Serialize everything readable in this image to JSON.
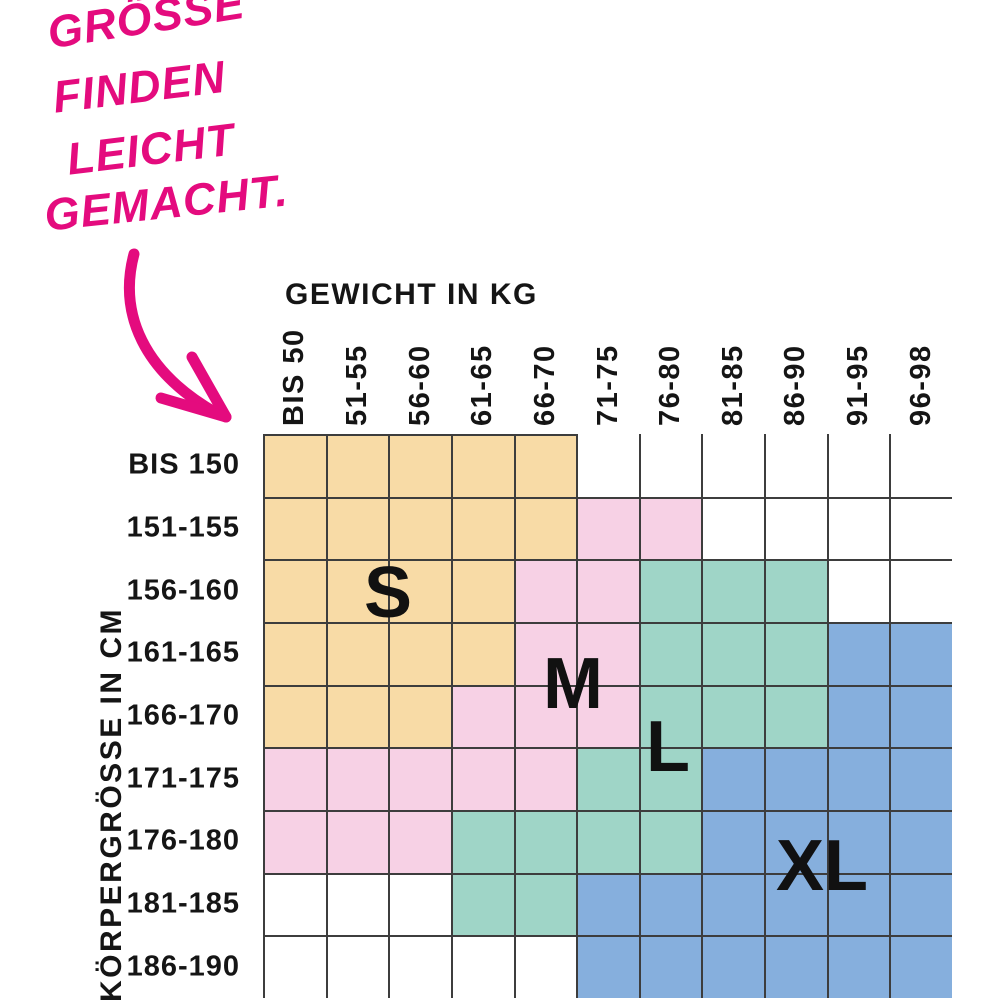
{
  "annotation": {
    "color": "#E40B7E",
    "lines": [
      {
        "text": "GRÖSSE",
        "x": 44,
        "y": 8,
        "rotate": -9
      },
      {
        "text": "FINDEN",
        "x": 50,
        "y": 72,
        "rotate": -7
      },
      {
        "text": "LEICHT",
        "x": 64,
        "y": 134,
        "rotate": -7
      },
      {
        "text": "GEMACHT.",
        "x": 42,
        "y": 190,
        "rotate": -6
      }
    ]
  },
  "chart_data": {
    "type": "heatmap",
    "title_columns": "GEWICHT IN KG",
    "title_rows": "KÖRPERGRÖSSE IN CM",
    "columns": [
      "BIS 50",
      "51-55",
      "56-60",
      "61-65",
      "66-70",
      "71-75",
      "76-80",
      "81-85",
      "86-90",
      "91-95",
      "96-98"
    ],
    "rows": [
      "BIS 150",
      "151-155",
      "156-160",
      "161-165",
      "166-170",
      "171-175",
      "176-180",
      "181-185",
      "186-190"
    ],
    "legend": [
      {
        "size": "S",
        "color": "#F8DBA6"
      },
      {
        "size": "M",
        "color": "#F7D1E5"
      },
      {
        "size": "L",
        "color": "#9FD5C7"
      },
      {
        "size": "XL",
        "color": "#86AFDD"
      }
    ],
    "matrix": [
      [
        "S",
        "S",
        "S",
        "S",
        "S",
        "",
        "",
        "",
        "",
        "",
        ""
      ],
      [
        "S",
        "S",
        "S",
        "S",
        "S",
        "M",
        "M",
        "",
        "",
        "",
        ""
      ],
      [
        "S",
        "S",
        "S",
        "S",
        "M",
        "M",
        "L",
        "L",
        "L",
        "",
        ""
      ],
      [
        "S",
        "S",
        "S",
        "S",
        "M",
        "M",
        "L",
        "L",
        "L",
        "XL",
        "XL"
      ],
      [
        "S",
        "S",
        "S",
        "M",
        "M",
        "M",
        "L",
        "L",
        "L",
        "XL",
        "XL"
      ],
      [
        "M",
        "M",
        "M",
        "M",
        "M",
        "L",
        "L",
        "XL",
        "XL",
        "XL",
        "XL"
      ],
      [
        "M",
        "M",
        "M",
        "L",
        "L",
        "L",
        "L",
        "XL",
        "XL",
        "XL",
        "XL"
      ],
      [
        "",
        "",
        "",
        "L",
        "L",
        "XL",
        "XL",
        "XL",
        "XL",
        "XL",
        "XL"
      ],
      [
        "",
        "",
        "",
        "",
        "",
        "XL",
        "XL",
        "XL",
        "XL",
        "XL",
        "XL"
      ]
    ],
    "size_labels": [
      {
        "text": "S",
        "x": 388,
        "y": 593
      },
      {
        "text": "M",
        "x": 573,
        "y": 684
      },
      {
        "text": "L",
        "x": 668,
        "y": 747
      },
      {
        "text": "XL",
        "x": 822,
        "y": 866
      }
    ],
    "grid_line_color": "#3d3d3d"
  }
}
